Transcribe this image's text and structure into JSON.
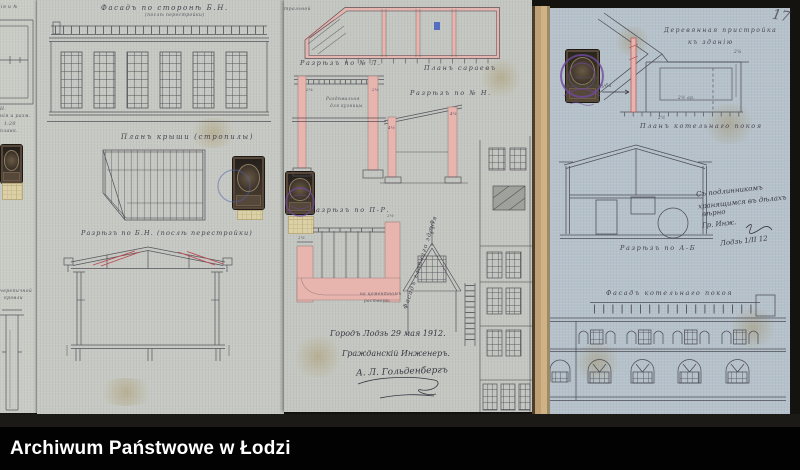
{
  "footer": {
    "label": "Archiwum Państwowe w Łodzi"
  },
  "page_number": "17",
  "colors": {
    "paper": "#c6c9c3",
    "paper_blue": "#b6c2cb",
    "ink": "#56525a",
    "pink_wash": "#e8b4ae",
    "red_ink": "#bb4a52",
    "purple_stamp": "#6f4aa0",
    "background": "#141310",
    "edge_tan": "#cfb285"
  },
  "sheet_a": {
    "frag_top": "ія и №",
    "frag_1": "Н.",
    "frag_2": "нія и разм.",
    "frag_3": "1:20",
    "frag_4": "планк.",
    "frag_5": "черепичной",
    "frag_6": "кровли"
  },
  "sheet_b": {
    "facade_title": "Фасадъ по сторонѣ Б.Н.",
    "facade_subtitle": "(послѣ перестройки)",
    "roof_plan_title": "Планъ крыши (стропилы)",
    "section_title": "Разрѣзъ по Б.Н. (послѣ перестройки)"
  },
  "sheet_c": {
    "frag_top": "тральной",
    "section_l_label": "Разрѣзъ по № Л.",
    "shed_plan_label": "Планъ сараевъ",
    "section_n_label": "Разрѣзъ по № Н.",
    "section_pr_label": "Разрѣзъ по П-Р.",
    "room_note_1": "Раздѣвальня",
    "room_note_2": "для кузницы",
    "pr_note_1": "на цементномъ",
    "pr_note_2": "растворѣ",
    "diagonal_label": "Фасадъ главнаго зданія",
    "signature_line_1": "Городъ Лодзь 29 мая 1912.",
    "signature_line_2": "Гражданскій Инженеръ.",
    "signature_name": "А. Л. Гольденбергъ"
  },
  "sheet_d": {
    "annex_title_1": "Деревянная пристройка",
    "annex_title_2": "къ зданію",
    "chimney_note_1": "Сквозная",
    "chimney_note_2": "кирпичн. труба",
    "boiler_plan_label": "Планъ котельнаго покоя",
    "section_ab_label": "Разрѣзъ по А-Б",
    "boiler_facade_label": "Фасадъ котельнаго покоя",
    "certify_1": "Съ подлинникомъ",
    "certify_2": "хранящимся въ дѣлахъ",
    "certify_3": "вѣрно",
    "certify_4": "Гр. Инж.",
    "certify_date": "Лодзь 1/II 12"
  },
  "dims": {
    "c1": "2¼",
    "c2": "2¼",
    "c3": "4½",
    "c4": "4½",
    "c5": "2½",
    "c6": "2½",
    "d1": "2½ ар.",
    "d2": "2¼",
    "d3": "2½"
  }
}
